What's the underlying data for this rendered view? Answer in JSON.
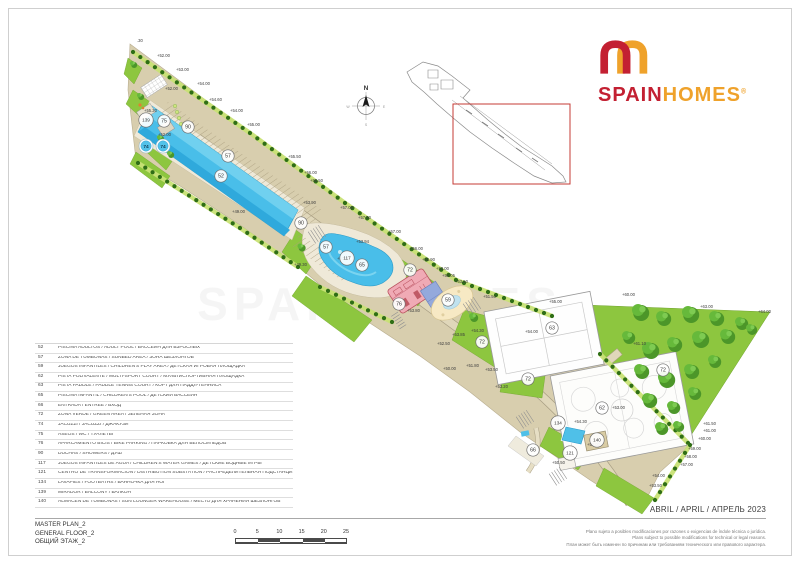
{
  "logo": {
    "spain": "SPAIN",
    "homes": "HOMES",
    "reg": "®"
  },
  "compass": {
    "n": "N",
    "w": "W",
    "e": "E",
    "s": "S"
  },
  "plan": {
    "watermark": "SPAINHOMES",
    "badges": [
      {
        "n": "139",
        "x": 146,
        "y": 120
      },
      {
        "n": "75",
        "x": 164,
        "y": 121
      },
      {
        "n": "90",
        "x": 188,
        "y": 127
      },
      {
        "n": "74",
        "x": 146,
        "y": 146
      },
      {
        "n": "74",
        "x": 163,
        "y": 146
      },
      {
        "n": "57",
        "x": 228,
        "y": 156
      },
      {
        "n": "52",
        "x": 221,
        "y": 176
      },
      {
        "n": "90",
        "x": 301,
        "y": 223
      },
      {
        "n": "57",
        "x": 326,
        "y": 247
      },
      {
        "n": "117",
        "x": 347,
        "y": 258
      },
      {
        "n": "65",
        "x": 362,
        "y": 265
      },
      {
        "n": "72",
        "x": 410,
        "y": 270
      },
      {
        "n": "76",
        "x": 399,
        "y": 304
      },
      {
        "n": "59",
        "x": 448,
        "y": 300
      },
      {
        "n": "72",
        "x": 482,
        "y": 342
      },
      {
        "n": "63",
        "x": 552,
        "y": 328
      },
      {
        "n": "72",
        "x": 528,
        "y": 379
      },
      {
        "n": "72",
        "x": 663,
        "y": 370
      },
      {
        "n": "62",
        "x": 602,
        "y": 408
      },
      {
        "n": "134",
        "x": 558,
        "y": 423
      },
      {
        "n": "140",
        "x": 597,
        "y": 440
      },
      {
        "n": "66",
        "x": 533,
        "y": 450
      },
      {
        "n": "121",
        "x": 570,
        "y": 453
      }
    ],
    "elevations": [
      {
        "t": ".30",
        "x": 137,
        "y": 42
      },
      {
        "t": "+52.00",
        "x": 157,
        "y": 57
      },
      {
        "t": "+53.00",
        "x": 176,
        "y": 71
      },
      {
        "t": "+54.00",
        "x": 197,
        "y": 85
      },
      {
        "t": "+52.00",
        "x": 165,
        "y": 90
      },
      {
        "t": "+54.60",
        "x": 209,
        "y": 101
      },
      {
        "t": "+55.20",
        "x": 144,
        "y": 112
      },
      {
        "t": "+54.00",
        "x": 230,
        "y": 112
      },
      {
        "t": "+52.00",
        "x": 158,
        "y": 136
      },
      {
        "t": "+55.00",
        "x": 247,
        "y": 126
      },
      {
        "t": "+55.50",
        "x": 288,
        "y": 158
      },
      {
        "t": "+56.00",
        "x": 304,
        "y": 174
      },
      {
        "t": "+56.50",
        "x": 310,
        "y": 182
      },
      {
        "t": "+49.00",
        "x": 232,
        "y": 213
      },
      {
        "t": "+53.90",
        "x": 303,
        "y": 204
      },
      {
        "t": "+57.00",
        "x": 340,
        "y": 209
      },
      {
        "t": "+57.50",
        "x": 358,
        "y": 219
      },
      {
        "t": "+49.30",
        "x": 294,
        "y": 266
      },
      {
        "t": "+57.00",
        "x": 388,
        "y": 233
      },
      {
        "t": "+53.94",
        "x": 356,
        "y": 243
      },
      {
        "t": "+56.00",
        "x": 410,
        "y": 250
      },
      {
        "t": "+55.90",
        "x": 422,
        "y": 261
      },
      {
        "t": "+53.40",
        "x": 337,
        "y": 260
      },
      {
        "t": "+53.00",
        "x": 436,
        "y": 270
      },
      {
        "t": "+54.05",
        "x": 442,
        "y": 277
      },
      {
        "t": "+53.50",
        "x": 455,
        "y": 283
      },
      {
        "t": "+53.80",
        "x": 407,
        "y": 312
      },
      {
        "t": "+51.50",
        "x": 483,
        "y": 298
      },
      {
        "t": "+54.30",
        "x": 471,
        "y": 332
      },
      {
        "t": "+54.00",
        "x": 525,
        "y": 333
      },
      {
        "t": "+55.00",
        "x": 549,
        "y": 303
      },
      {
        "t": "+53.85",
        "x": 452,
        "y": 336
      },
      {
        "t": "+52.50",
        "x": 437,
        "y": 345
      },
      {
        "t": "+50.00",
        "x": 443,
        "y": 370
      },
      {
        "t": "+51.80",
        "x": 466,
        "y": 367
      },
      {
        "t": "+53.50",
        "x": 485,
        "y": 371
      },
      {
        "t": "+53.20",
        "x": 495,
        "y": 388
      },
      {
        "t": "+60.00",
        "x": 622,
        "y": 296
      },
      {
        "t": "+63.00",
        "x": 700,
        "y": 308
      },
      {
        "t": "+64.00",
        "x": 758,
        "y": 313
      },
      {
        "t": "+61.10",
        "x": 633,
        "y": 345
      },
      {
        "t": "+53.00",
        "x": 612,
        "y": 409
      },
      {
        "t": "+54.30",
        "x": 574,
        "y": 423
      },
      {
        "t": "+53.00",
        "x": 587,
        "y": 446
      },
      {
        "t": "+50.50",
        "x": 552,
        "y": 464
      },
      {
        "t": "+61.50",
        "x": 703,
        "y": 425
      },
      {
        "t": "+61.00",
        "x": 703,
        "y": 432
      },
      {
        "t": "+60.00",
        "x": 698,
        "y": 440
      },
      {
        "t": "+59.00",
        "x": 688,
        "y": 450
      },
      {
        "t": "+58.00",
        "x": 684,
        "y": 458
      },
      {
        "t": "+57.00",
        "x": 680,
        "y": 466
      },
      {
        "t": "+54.00",
        "x": 652,
        "y": 477
      },
      {
        "t": "+53.50",
        "x": 649,
        "y": 487
      }
    ],
    "colors": {
      "green": "#8DC63F",
      "beige": "#D8CEAE",
      "pool_blue": "#49BEE9",
      "logo_red": "#C32032",
      "logo_orange": "#EFA22B",
      "keyplan_highlight": "#C43B36"
    }
  },
  "legend": {
    "rows": [
      {
        "num": "52",
        "desc": "PISCINA ADULTOS / ADULT POOL / БАССЕЙН ДЛЯ ВЗРОСЛЫХ"
      },
      {
        "num": "57",
        "desc": "ZONA DE TUMBONAS / SUNBED AREA / ЗОНА ШЕЗЛОНГОВ"
      },
      {
        "num": "59",
        "desc": "JUEGOS INFANTILES / CHILDREN'S PLAY AREA / ДЕТСКАЯ ИГРОВАЯ ПЛОЩАДКА"
      },
      {
        "num": "62",
        "desc": "PISTA POLIVALENTE / MULTI-SPORT COURT / МУЛЬТИСПОРТИВНАЯ ПЛОЩАДКА"
      },
      {
        "num": "63",
        "desc": "PISTA PADDLE /  PADDLE TENNIS COURT /  КОРТ ДЛЯ ПАДДЛ-ТЕННИСА"
      },
      {
        "num": "65",
        "desc": "PISCINA INFANTIL / CHILDREN'S POOL / ДЕТСКИЙ БАССЕЙН"
      },
      {
        "num": "66",
        "desc": "ENTRADA / ENTRÉE / ВХОД"
      },
      {
        "num": "72",
        "desc": "ZONA VERDE / GREEN AREA / ЗЕЛЕНАЯ ЗОНА"
      },
      {
        "num": "74",
        "desc": "JACUZZI / JACUZZI / ДЖАКУЗИ"
      },
      {
        "num": "75",
        "desc": "ASEOS / WC / ТУАЛЕТЫ"
      },
      {
        "num": "76",
        "desc": "APARCAMIENTO BICIS / BIKE PARKING / ПАРКОВКА ДЛЯ ВЕЛОСИПЕДОВ"
      },
      {
        "num": "90",
        "desc": "DUCHAS / SHOWERS / ДУШ"
      },
      {
        "num": "117",
        "desc": "JUEGOS INFANTILES DE AGUA / CHILDREN'S WATER GAMES / ДЕТСКИЕ ВОДНЫЕ ИГРЫ"
      },
      {
        "num": "121",
        "desc": "CENTRO DE TRANSFORMACIÓN / DISTRIBUTION SUBSTATION / РАСПРЕДЕЛИТЕЛЬНАЯ ПОДСТАНЦИЯ"
      },
      {
        "num": "134",
        "desc": "LAVAPIES / FOOTBATHS / ВАННОЧКА ДЛЯ НОГ"
      },
      {
        "num": "139",
        "desc": "MIRADOR / BALCONY / БАЛКОН"
      },
      {
        "num": "140",
        "desc": "ALMACÉN DE TUMBONAS  / SUN LOUNGER WAREHOUSE / МЕСТО ДЛЯ ХРАНЕНИЯ ШЕЗЛОНГОВ"
      }
    ]
  },
  "titleblock": {
    "line1": "MASTER PLAN_2",
    "line2": "GENERAL FLOOR_2",
    "line3": "ОБЩИЙ ЭТАЖ_2"
  },
  "date_line": "ABRIL / APRIL / АПРЕЛЬ 2023",
  "disclaimer": {
    "es": "Plano sujeto a posibles modificaciones por razones o exigencias de índole técnica o jurídica.",
    "en": "Plans subject to possible modifications for technical or legal reasons.",
    "ru": "План может быть изменен по причинам или требованиям технического или правового характера."
  },
  "scalebar": {
    "ticks": [
      "0",
      "5",
      "10",
      "15",
      "20",
      "25"
    ]
  }
}
